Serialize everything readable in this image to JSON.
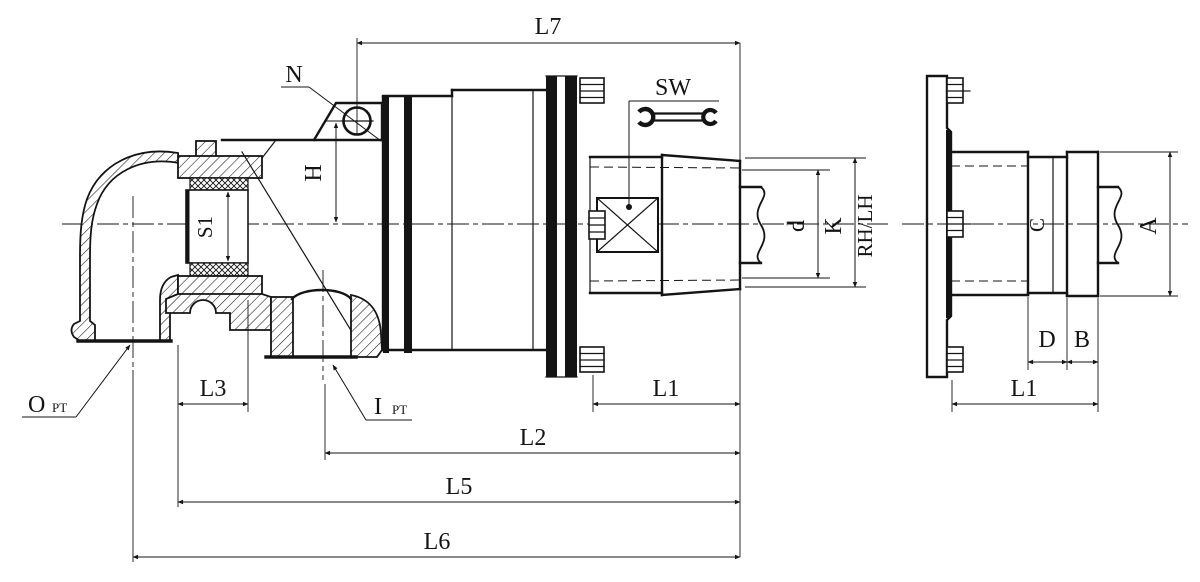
{
  "drawing": {
    "kind": "rotary-joint-section-drawing",
    "background": "#ffffff",
    "line_color": "#141414"
  },
  "main_view": {
    "dims": {
      "L7": "L7",
      "H": "H",
      "S1": "S1",
      "d": "d",
      "K": "K",
      "L1": "L1",
      "L2": "L2",
      "L3": "L3",
      "L5": "L5",
      "L6": "L6"
    },
    "annotations": {
      "N": "N",
      "SW": "SW",
      "RH_LH": "RH/LH",
      "O_port": {
        "text": "O",
        "sub": "PT"
      },
      "I_port": {
        "text": "I",
        "sub": "PT"
      }
    }
  },
  "side_view": {
    "dims": {
      "A": "A",
      "B": "B",
      "C": "C",
      "D": "D",
      "L1": "L1"
    }
  }
}
